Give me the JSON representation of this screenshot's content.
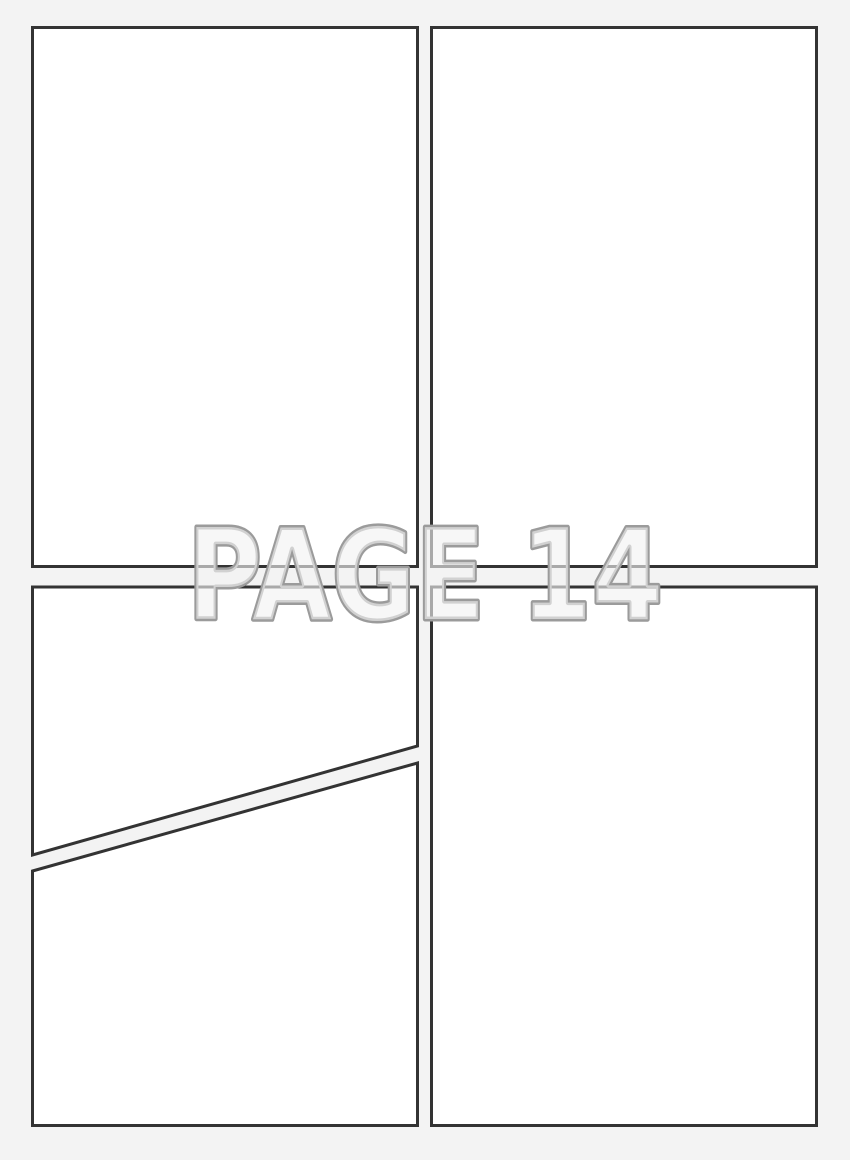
{
  "page": {
    "label": "PAGE 14",
    "colors": {
      "background": "#f3f3f3",
      "panel_fill": "#ffffff",
      "panel_border": "#333333",
      "label_outline": "#9b9b9b",
      "label_fill": "#f2f2f2"
    }
  }
}
